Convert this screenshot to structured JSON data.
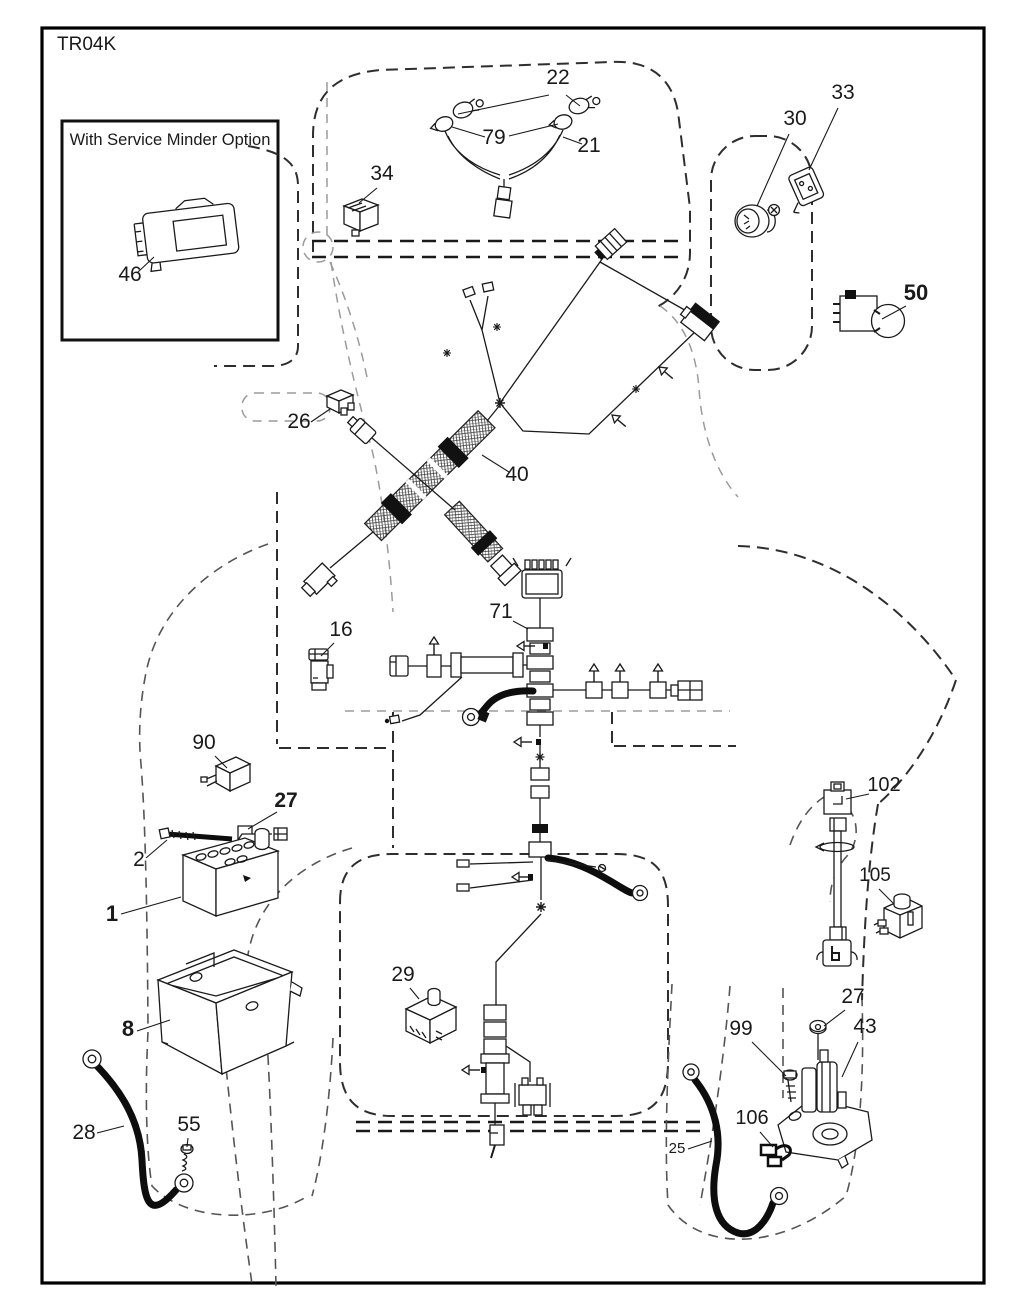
{
  "page": {
    "title": "TR04K"
  },
  "inset": {
    "label": "With Service Minder Option"
  },
  "colors": {
    "ink": "#1a1a1a",
    "background": "#ffffff",
    "dashed_outline": "#2e2e2e",
    "light_outline": "#9b9b9b"
  },
  "callouts": [
    {
      "text": "46",
      "x": 130,
      "y": 281,
      "size": 21,
      "bold": false,
      "leaders": [
        [
          138,
          272,
          154,
          257
        ]
      ]
    },
    {
      "text": "22",
      "x": 558,
      "y": 84,
      "size": 21,
      "bold": false,
      "leaders": [
        [
          549,
          95,
          458,
          114
        ],
        [
          566,
          95,
          580,
          106
        ]
      ]
    },
    {
      "text": "79",
      "x": 494,
      "y": 144,
      "size": 21,
      "bold": false,
      "leaders": [
        [
          485,
          137,
          452,
          127
        ],
        [
          509,
          136,
          558,
          124
        ]
      ]
    },
    {
      "text": "21",
      "x": 589,
      "y": 152,
      "size": 21,
      "bold": false,
      "leaders": [
        [
          582,
          144,
          563,
          137
        ]
      ]
    },
    {
      "text": "34",
      "x": 382,
      "y": 180,
      "size": 21,
      "bold": false,
      "leaders": [
        [
          377,
          188,
          359,
          203
        ]
      ]
    },
    {
      "text": "30",
      "x": 795,
      "y": 125,
      "size": 21,
      "bold": false,
      "leaders": [
        [
          789,
          134,
          757,
          206
        ]
      ]
    },
    {
      "text": "33",
      "x": 843,
      "y": 99,
      "size": 21,
      "bold": false,
      "leaders": [
        [
          838,
          108,
          809,
          170
        ]
      ]
    },
    {
      "text": "50",
      "x": 916,
      "y": 300,
      "size": 22,
      "bold": true,
      "leaders": [
        [
          906,
          306,
          882,
          319
        ]
      ]
    },
    {
      "text": "26",
      "x": 299,
      "y": 428,
      "size": 21,
      "bold": false,
      "leaders": [
        [
          311,
          422,
          330,
          409
        ]
      ]
    },
    {
      "text": "40",
      "x": 517,
      "y": 481,
      "size": 21,
      "bold": false,
      "leaders": [
        [
          509,
          472,
          482,
          455
        ]
      ]
    },
    {
      "text": "71",
      "x": 501,
      "y": 618,
      "size": 21,
      "bold": false,
      "leaders": [
        [
          513,
          621,
          528,
          629
        ]
      ]
    },
    {
      "text": "16",
      "x": 341,
      "y": 636,
      "size": 21,
      "bold": false,
      "leaders": [
        [
          334,
          643,
          321,
          656
        ]
      ]
    },
    {
      "text": "90",
      "x": 204,
      "y": 749,
      "size": 21,
      "bold": false,
      "leaders": [
        [
          215,
          756,
          227,
          768
        ]
      ]
    },
    {
      "text": "27",
      "x": 286,
      "y": 807,
      "size": 21,
      "bold": true,
      "leaders": [
        [
          277,
          812,
          248,
          829
        ]
      ]
    },
    {
      "text": "2",
      "x": 139,
      "y": 866,
      "size": 21,
      "bold": false,
      "leaders": [
        [
          146,
          858,
          167,
          840
        ]
      ]
    },
    {
      "text": "1",
      "x": 112,
      "y": 921,
      "size": 22,
      "bold": true,
      "leaders": [
        [
          121,
          914,
          181,
          897
        ]
      ]
    },
    {
      "text": "8",
      "x": 128,
      "y": 1036,
      "size": 22,
      "bold": true,
      "leaders": [
        [
          137,
          1031,
          170,
          1020
        ]
      ]
    },
    {
      "text": "29",
      "x": 403,
      "y": 981,
      "size": 21,
      "bold": false,
      "leaders": [
        [
          410,
          988,
          419,
          999
        ]
      ]
    },
    {
      "text": "28",
      "x": 84,
      "y": 1139,
      "size": 21,
      "bold": false,
      "leaders": [
        [
          97,
          1133,
          124,
          1126
        ]
      ]
    },
    {
      "text": "55",
      "x": 189,
      "y": 1131,
      "size": 21,
      "bold": false,
      "leaders": [
        [
          188,
          1138,
          187,
          1147
        ]
      ]
    },
    {
      "text": "25",
      "x": 677,
      "y": 1153,
      "size": 15,
      "bold": false,
      "leaders": [
        [
          688,
          1149,
          712,
          1141
        ]
      ]
    },
    {
      "text": "99",
      "x": 741,
      "y": 1035,
      "size": 21,
      "bold": false,
      "leaders": [
        [
          752,
          1042,
          786,
          1076
        ]
      ]
    },
    {
      "text": "106",
      "x": 752,
      "y": 1124,
      "size": 20,
      "bold": false,
      "leaders": [
        [
          760,
          1132,
          773,
          1147
        ]
      ]
    },
    {
      "text": "102",
      "x": 884,
      "y": 791,
      "size": 20,
      "bold": false,
      "leaders": [
        [
          869,
          794,
          846,
          799
        ]
      ]
    },
    {
      "text": "105",
      "x": 875,
      "y": 881,
      "size": 19,
      "bold": false,
      "leaders": [
        [
          879,
          889,
          893,
          903
        ]
      ]
    },
    {
      "text": "27",
      "x": 853,
      "y": 1003,
      "size": 21,
      "bold": false,
      "leaders": [
        [
          845,
          1010,
          824,
          1026
        ]
      ]
    },
    {
      "text": "43",
      "x": 865,
      "y": 1033,
      "size": 21,
      "bold": false,
      "leaders": [
        [
          858,
          1042,
          842,
          1077
        ]
      ]
    }
  ]
}
